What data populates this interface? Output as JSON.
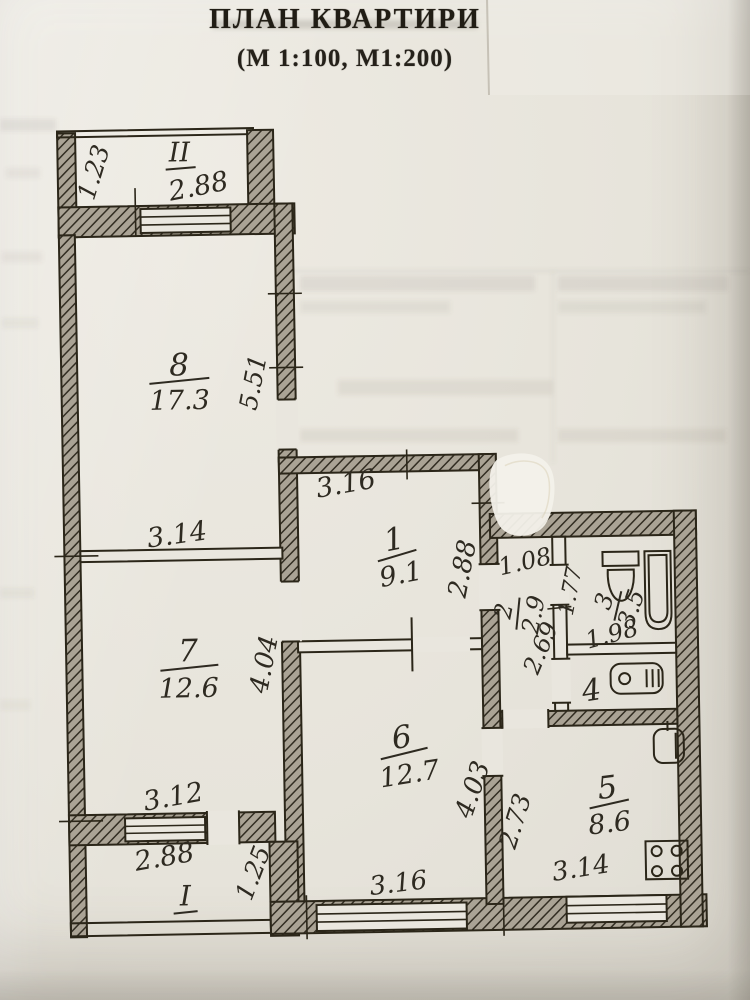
{
  "document": {
    "title": "ПЛАН КВАРТИРИ",
    "subtitle": "(М 1:100, М1:200)"
  },
  "plan": {
    "balcony_ii": {
      "label": "II",
      "width": "2.88",
      "depth": "1.23"
    },
    "balcony_i": {
      "label": "I",
      "outer_width": "3.12",
      "width": "2.88",
      "depth": "1.25"
    },
    "room1": {
      "number": "1",
      "area": "9.1",
      "width": "3.16",
      "depth": "2.88"
    },
    "room2": {
      "number": "2",
      "area": "2.9",
      "width": "1.08",
      "depth": "2.69"
    },
    "room3": {
      "number": "3",
      "area": "3.5",
      "width": "1.77",
      "length": "1.98"
    },
    "room4": {
      "number": "4"
    },
    "room5": {
      "number": "5",
      "area": "8.6",
      "width": "3.14",
      "depth": "2.73"
    },
    "room6": {
      "number": "6",
      "area": "12.7",
      "width": "3.16",
      "depth": "4.03"
    },
    "room7": {
      "number": "7",
      "area": "12.6",
      "width": "3.14",
      "depth": "4.04"
    },
    "room8": {
      "number": "8",
      "area": "17.3",
      "depth": "5.51"
    }
  },
  "fixtures": {
    "toilet": "toilet-icon",
    "bathtub": "bathtub-icon",
    "washbasin": "washbasin-icon",
    "sink": "sink-icon",
    "stove": "stove-icon"
  },
  "colors": {
    "ink": "#2e2a21",
    "paper": "#e8e5dd"
  }
}
